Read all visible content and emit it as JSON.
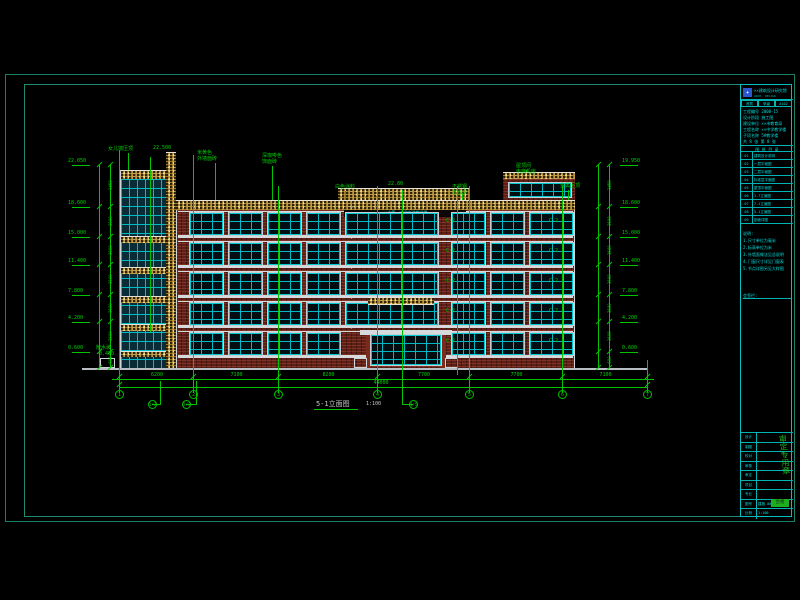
{
  "drawing": {
    "title": "5-1立面图",
    "scale": "1:100",
    "axis_labels": [
      "1",
      "2",
      "3",
      "4",
      "5",
      "6",
      "7"
    ],
    "offset_axis_labels": [
      "1/2",
      "2/3",
      "4/5"
    ],
    "dim_segments": [
      "6200",
      "7100",
      "8200",
      "7700",
      "7700",
      "7100"
    ],
    "dim_total": "44000",
    "levels_left": [
      "22.050",
      "18.600",
      "15.000",
      "11.400",
      "7.800",
      "4.200",
      "0.600"
    ],
    "levels_right": [
      "19.950",
      "18.600",
      "15.000",
      "11.400",
      "7.800",
      "4.200",
      "0.600"
    ],
    "floor_dims_left": [
      "3450",
      "3600",
      "3600",
      "3600",
      "3600",
      "3600",
      "600"
    ],
    "floor_dims_right": [
      "3450",
      "3600",
      "3600",
      "3600",
      "3600",
      "3600",
      "600"
    ],
    "tower_callouts": [
      {
        "lines": [
          "女儿墙压顶"
        ]
      },
      {
        "lines": [
          "22.500"
        ]
      }
    ],
    "callouts": [
      {
        "lines": [
          "米黄色",
          "外墙面砖"
        ]
      },
      {
        "lines": [
          "深咖啡色",
          "饰面砖"
        ]
      },
      {
        "lines": [
          "白色涂料"
        ]
      },
      {
        "lines": [
          "22.80"
        ]
      },
      {
        "lines": [
          "不锈钢",
          "发光字"
        ]
      },
      {
        "lines": [
          "金属压顶"
        ]
      },
      {
        "lines": [
          "屋顶间",
          "电梯机房"
        ]
      }
    ],
    "sign_text": "××市第一中学实验教学楼",
    "window_mark": "C-2",
    "level_mark": "▽",
    "ground_note": [
      "散水坡",
      "-0.450"
    ]
  },
  "title_block": {
    "logo_glyph": "✦",
    "company": "××建筑设计研究院",
    "company_en": "ARCH. DESIGN INSTITUTE",
    "cert_cells": [
      "资质",
      "甲级",
      "A102"
    ],
    "info_lines": [
      "工程编号 2008-15",
      "设计阶段 施工图",
      "建设单位 ××市教育局",
      "工程名称 ××中学教学楼",
      "子项名称 5#教学楼",
      "共 8 张  第 8 张"
    ],
    "table_header": "图 纸 目 录",
    "table_rows": [
      [
        "01",
        "建筑设计说明"
      ],
      [
        "02",
        "一层平面图"
      ],
      [
        "03",
        "二层平面图"
      ],
      [
        "04",
        "标准层平面图"
      ],
      [
        "05",
        "屋顶平面图"
      ],
      [
        "06",
        "1-7立面图"
      ],
      [
        "07",
        "7-1立面图"
      ],
      [
        "08",
        "5-1立面图"
      ],
      [
        "09",
        "剖面详图"
      ]
    ],
    "notes_lines": [
      "说明:",
      "1.尺寸单位为毫米",
      "2.标高单位为米",
      "3.外墙面做法见总说明",
      "4.门窗尺寸详见门窗表",
      "5.节点详图另见大样图"
    ],
    "sign_label": "会签栏:",
    "bottom_rows": [
      [
        "设计",
        ""
      ],
      [
        "制图",
        ""
      ],
      [
        "校对",
        ""
      ],
      [
        "审核",
        ""
      ],
      [
        "审定",
        ""
      ],
      [
        "项目",
        ""
      ],
      [
        "专业",
        ""
      ],
      [
        "图号",
        "建施-08"
      ],
      [
        "比例",
        "1:100"
      ]
    ],
    "stamp_text": "审定专用章",
    "badge_text": "合格"
  }
}
